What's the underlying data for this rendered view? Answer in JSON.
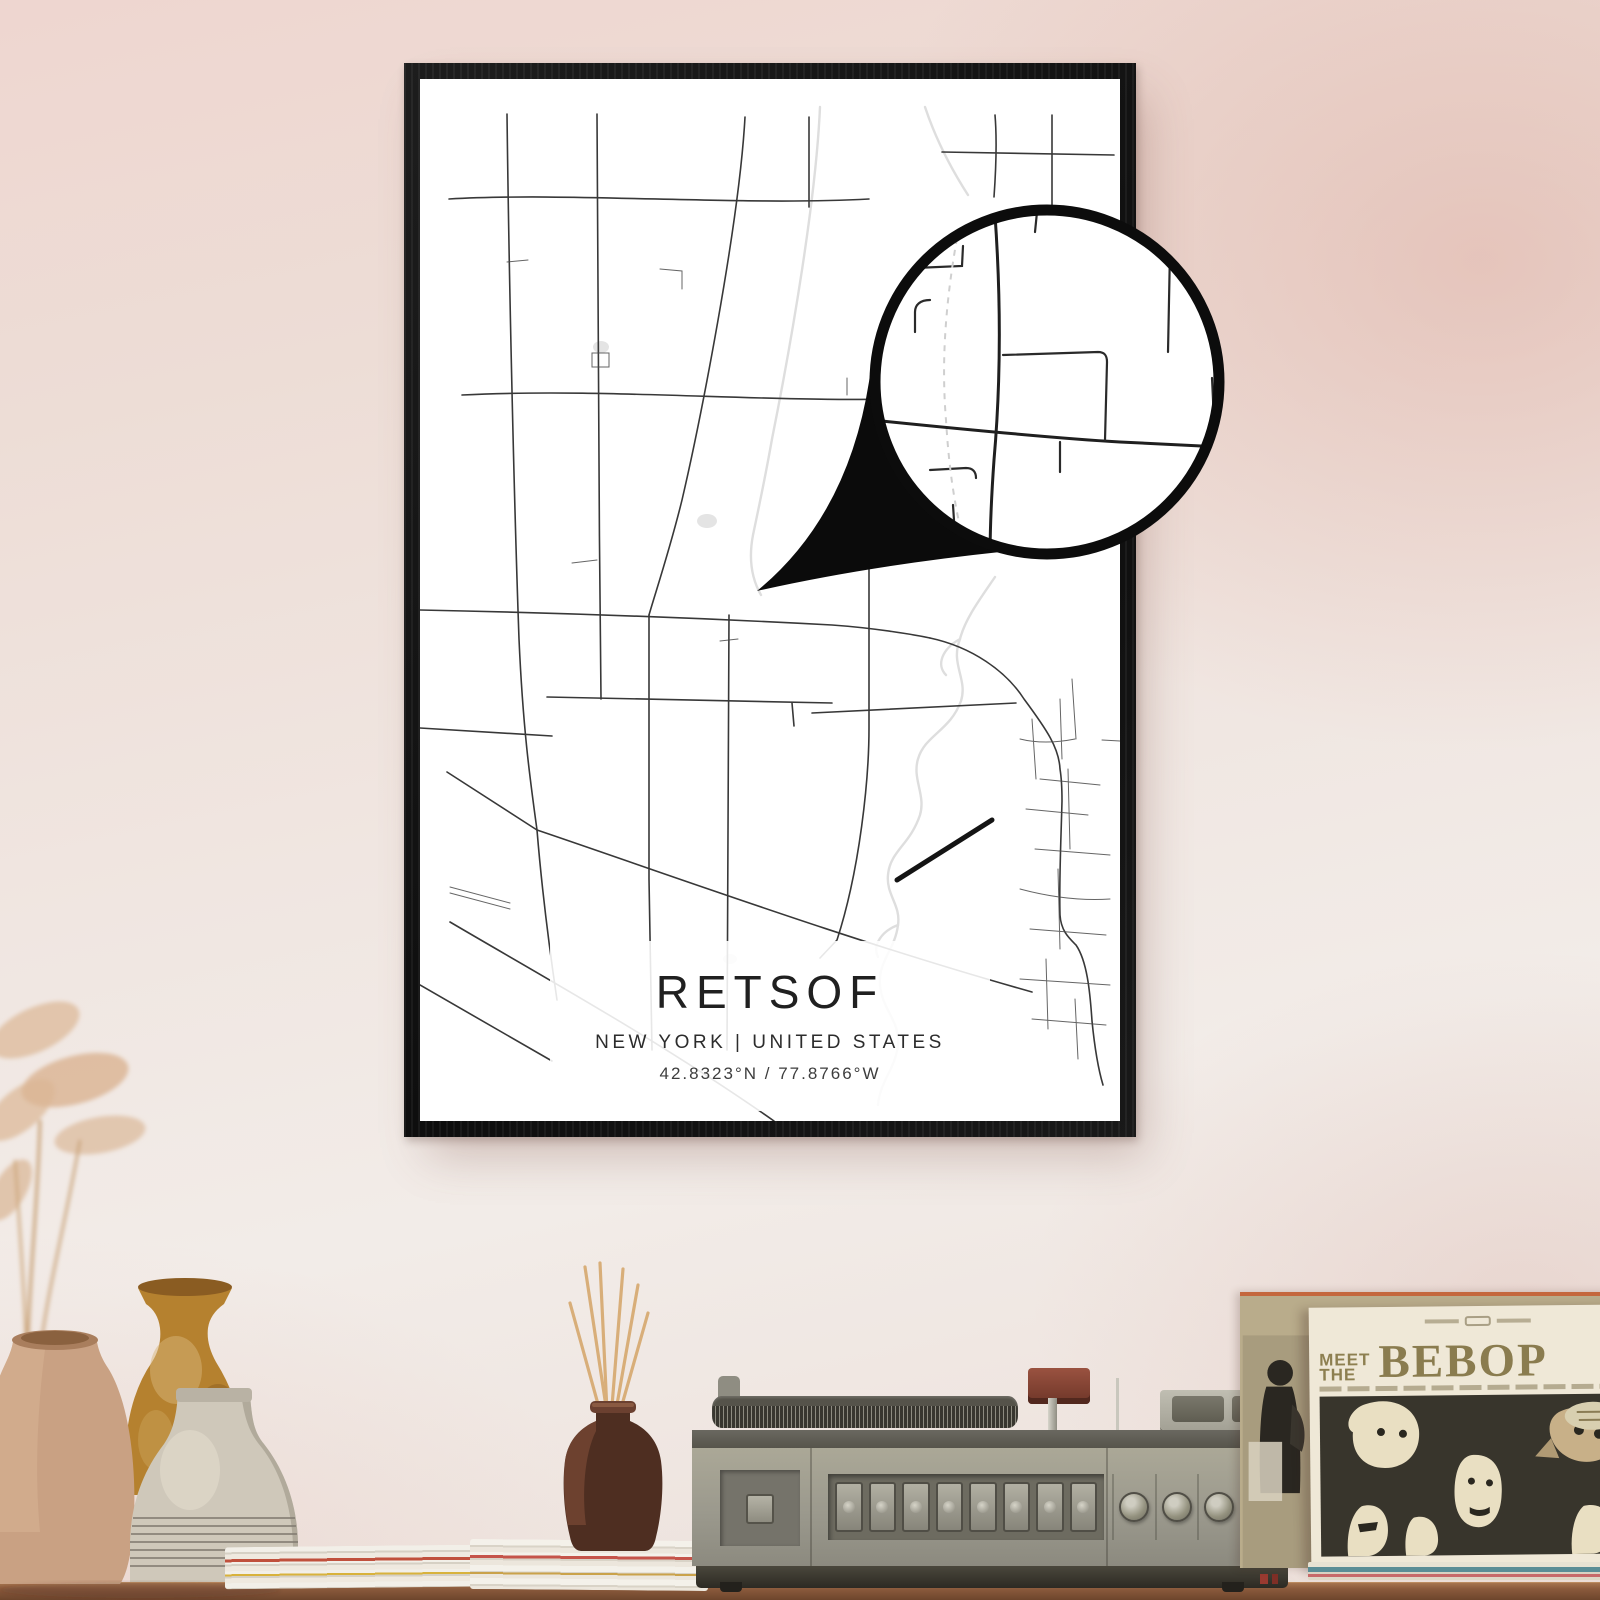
{
  "poster": {
    "title": "RETSOF",
    "subtitle": "NEW YORK | UNITED STATES",
    "coordinates": "42.8323°N / 77.8766°W",
    "frame_color": "#141414",
    "paper_color": "#ffffff",
    "road_color": "#383838",
    "water_color": "#dedede",
    "railroad_segment_color": "#141414"
  },
  "magnifier": {
    "border_color": "#0c0c0c",
    "fill_color": "#ffffff",
    "curl_color": "#0b0b0b"
  },
  "wall": {
    "top_color": "#eed6d0",
    "center_color": "#f0e6e1",
    "right_tint": "#deaea3"
  },
  "album": {
    "pretitle_line1": "MEET",
    "pretitle_line2": "THE",
    "title": "BEBOP",
    "title_color": "#8a7c4f",
    "sleeve_color": "#efe8d7",
    "art_background": "#38352c",
    "back_sleeve_color": "#b9ac8b"
  },
  "player": {
    "body_color": "#9b998d",
    "base_color": "#2c2a23",
    "preset_button_count": 8,
    "knob_count": 4
  },
  "decor": {
    "pampas_color": "#dcb694",
    "clay_jug_color": "#c9a183",
    "amber_vase_color": "#b5812f",
    "white_vase_color": "#cfc8ba",
    "diffuser_bottle_color": "#4e2e21",
    "reed_stick_color": "#d8ae79",
    "shelf_wood_color": "#8a5a3c"
  }
}
